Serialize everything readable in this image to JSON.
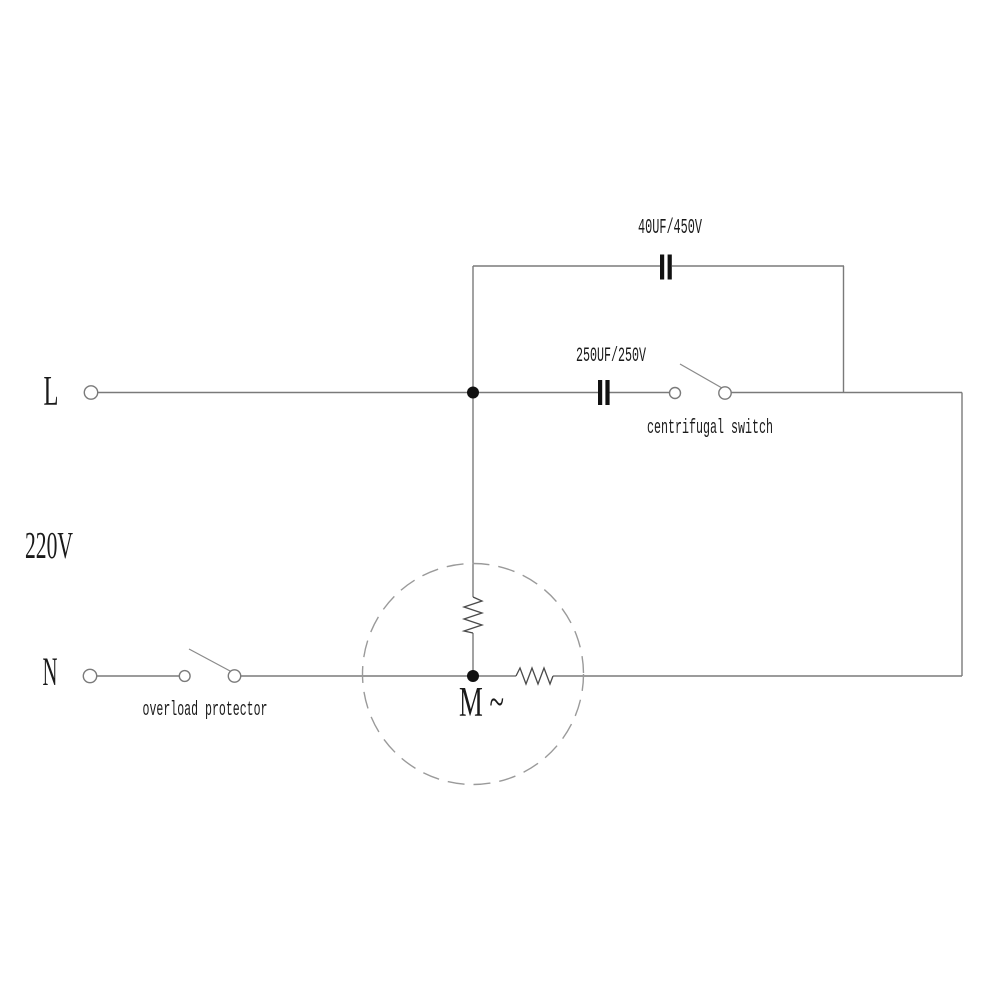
{
  "diagram": {
    "kind": "single-phase-motor-wiring-schematic",
    "labels": {
      "line_l": "L",
      "line_n": "N",
      "voltage": "220V",
      "start_capacitor": "40UF/450V",
      "run_capacitor": "250UF/250V",
      "centrifugal_switch": "centrifugal switch",
      "overload_protector": "overload protector",
      "motor": "M ~"
    },
    "colors": {
      "background": "#ffffff",
      "wire": "#7a7a7a",
      "text": "#1a1a1a",
      "component": "#111111",
      "motor_outline": "#9a9a9a"
    }
  }
}
